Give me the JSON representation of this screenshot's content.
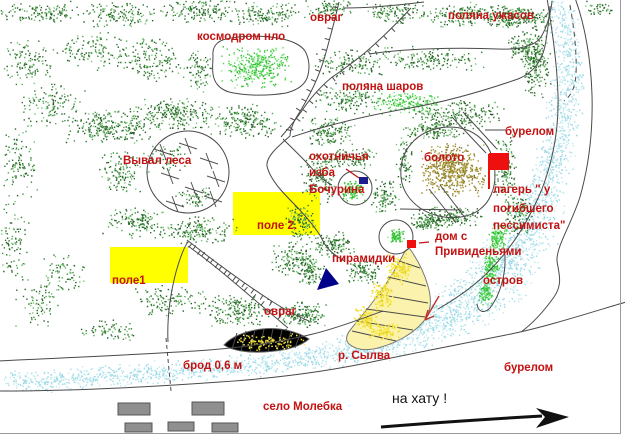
{
  "map": {
    "description": "hand-drawn trail map of anomalous zone near Molebka village",
    "river_name": "р. Сылва",
    "village_name": "село Молебка"
  },
  "colors": {
    "label_red": "#c41111",
    "route_black": "#111111",
    "field_yellow": "#ffff00",
    "flag_red": "#ee0f0f",
    "marker_red": "#ee0f0f",
    "pyramid_navy": "#00008b",
    "hut_navy": "#1c1c8e",
    "building_gray": "#8f8f8f",
    "building_edge": "#555555",
    "forest_green": "#3f8f3f",
    "swamp_olive": "#9a8c2e",
    "river_blue": "#aadfe9",
    "sand_yellow": "#f0dd30",
    "line_gray": "#4a4a4a"
  },
  "labels": [
    {
      "text": "овраг",
      "x": 310,
      "y": 12
    },
    {
      "text": "космодром нло",
      "x": 197,
      "y": 31
    },
    {
      "text": "поляна ужасов",
      "x": 448,
      "y": 10
    },
    {
      "text": "поляна шаров",
      "x": 342,
      "y": 81
    },
    {
      "text": "Вывал леса",
      "x": 123,
      "y": 155
    },
    {
      "text": "охотничья",
      "x": 309,
      "y": 151
    },
    {
      "text": "изба",
      "x": 309,
      "y": 167
    },
    {
      "text": "Бочурина",
      "x": 309,
      "y": 184
    },
    {
      "text": "болото",
      "x": 424,
      "y": 152
    },
    {
      "text": "бурелом",
      "x": 505,
      "y": 126
    },
    {
      "text": "лагерь \" у",
      "x": 493,
      "y": 184
    },
    {
      "text": "погибшего",
      "x": 493,
      "y": 203
    },
    {
      "text": "пессимиста\"",
      "x": 493,
      "y": 220
    },
    {
      "text": "поле 2.",
      "x": 257,
      "y": 220
    },
    {
      "text": "поле1",
      "x": 112,
      "y": 275
    },
    {
      "text": "дом с",
      "x": 435,
      "y": 231
    },
    {
      "text": "Привиденьями",
      "x": 435,
      "y": 246
    },
    {
      "text": "пирамидки",
      "x": 332,
      "y": 253
    },
    {
      "text": "остров",
      "x": 483,
      "y": 275
    },
    {
      "text": "овраг",
      "x": 264,
      "y": 306
    },
    {
      "text": "р. Сылва",
      "x": 338,
      "y": 350
    },
    {
      "text": "брод 0,6 м",
      "x": 183,
      "y": 360
    },
    {
      "text": "бурелом",
      "x": 504,
      "y": 362
    },
    {
      "text": "село Молебка",
      "x": 263,
      "y": 401
    },
    {
      "text": "на хату !",
      "x": 392,
      "y": 392,
      "style": "black"
    }
  ],
  "features": {
    "fields": [
      {
        "name": "field-1",
        "x": 110,
        "y": 247,
        "w": 78,
        "h": 36
      },
      {
        "name": "field-2",
        "x": 233,
        "y": 192,
        "w": 87,
        "h": 43
      }
    ],
    "village_buildings": [
      [
        118,
        403,
        32,
        12
      ],
      [
        192,
        402,
        32,
        13
      ],
      [
        125,
        423,
        27,
        9
      ],
      [
        168,
        422,
        26,
        9
      ],
      [
        212,
        423,
        26,
        9
      ]
    ],
    "camp_flag": {
      "pole_x": 489,
      "pole_y1": 154,
      "pole_y2": 189,
      "flag_w": 20,
      "flag_h": 17
    },
    "haunted_house_marker": {
      "x": 407,
      "y": 240,
      "w": 9,
      "h": 8
    },
    "hunter_hut_marker": {
      "x": 359,
      "y": 177,
      "w": 9,
      "h": 7
    },
    "pyramids_marker": {
      "points": "317,290 339,284 326,268"
    },
    "ford_depth_m": "0,6"
  }
}
